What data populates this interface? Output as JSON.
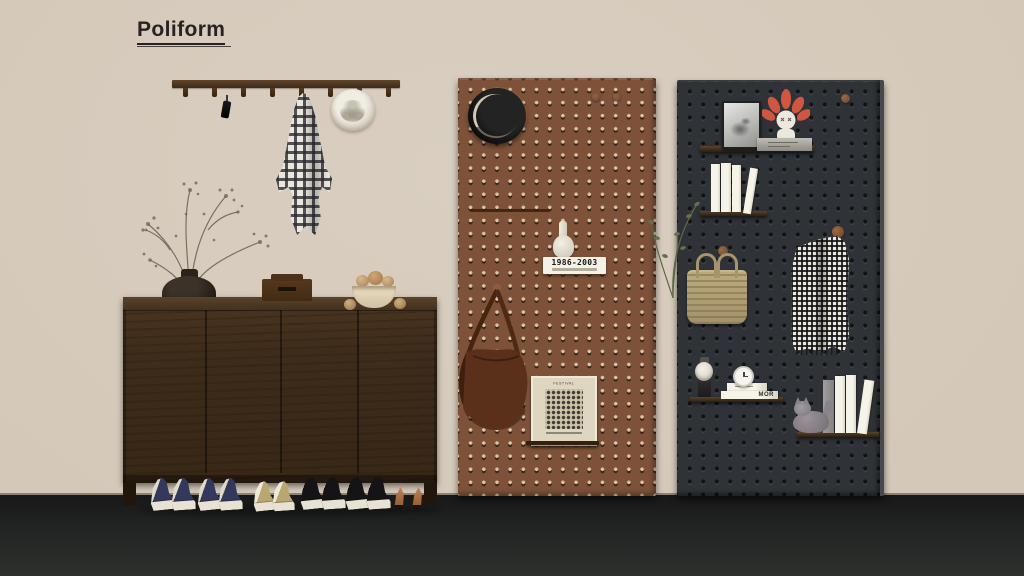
{
  "brand": {
    "logo_text": "Poliform"
  },
  "palette": {
    "wall": "#d6cabb",
    "floor": "#1c1d1c",
    "cabinet_wood": "#3e2c1a",
    "pegboard_brown": "#7d5239",
    "pegboard_charcoal": "#2f3337",
    "bag_leather": "#5b301b",
    "toy_red": "#cf5742",
    "basket_straw": "#b3a077"
  },
  "coat_rack": {
    "peg_count": 8,
    "items": [
      "black keychain",
      "plaid shirt",
      "panama hat"
    ]
  },
  "sideboard": {
    "door_count": 4,
    "top_items": [
      "branch vase",
      "wooden box",
      "bowl of bread"
    ]
  },
  "shoes": {
    "pairs": [
      "navy sneakers",
      "navy sneakers",
      "beige sneakers",
      "black sneakers",
      "black sneakers",
      "tan heels"
    ]
  },
  "pegboard_brown": {
    "items": [
      "black hat",
      "hanging rod",
      "white figurine",
      "year plaque",
      "leather crossbody bag",
      "framed poster"
    ],
    "plaque_text": "1986-2003",
    "poster_title": "FESTIVAL"
  },
  "pegboard_charcoal": {
    "items": [
      "framed photo",
      "art toy on plinth",
      "white books",
      "green plant",
      "straw tote bag",
      "houndstooth coat",
      "figurine with hat",
      "alarm clock",
      "book stack",
      "cat figurine",
      "leaning books"
    ],
    "book_spine_text": "MOR"
  }
}
